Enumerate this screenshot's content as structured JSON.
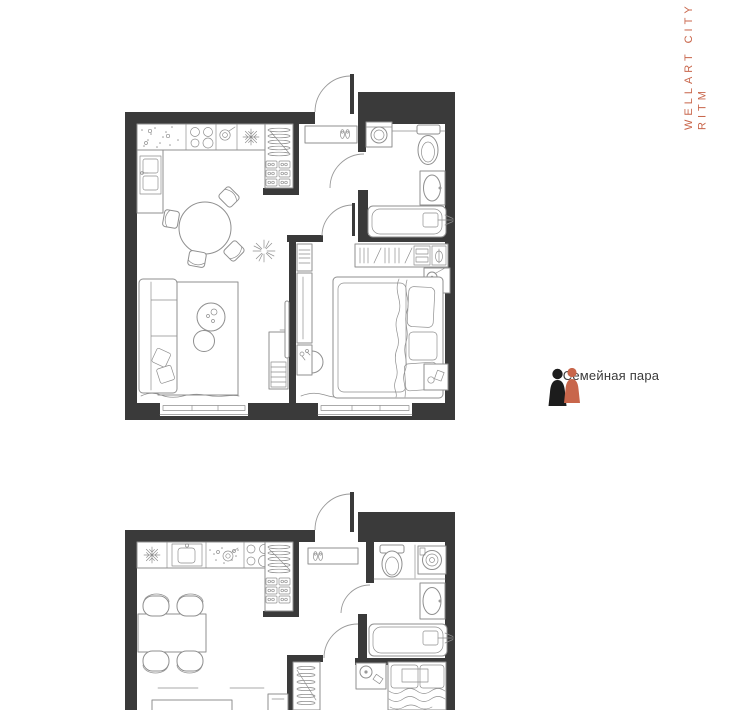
{
  "branding": {
    "line1": "WELLART CITY",
    "line2": "RITM",
    "accent_color": "#C8664B"
  },
  "legend": {
    "icon": "couple-icon",
    "label": "Семейная пара",
    "icon_colors": {
      "left_figure": "#1c1c1c",
      "right_figure": "#C8664B"
    },
    "text_color": "#3A3A3A"
  },
  "plans": [
    {
      "name": "floor-plan-top",
      "kind": "one-bedroom-apartment-plan",
      "features": [
        "entry-door",
        "hallway-shoe-bench",
        "kitchen-counter",
        "stove-icon",
        "fridge-snowflake-icon",
        "sink-icon",
        "round-dining-table",
        "four-chairs",
        "hall-closet-hangers",
        "plant-icon",
        "sofa",
        "rug",
        "coffee-tables",
        "tv-console",
        "bathroom-washing-machine",
        "toilet-icon",
        "washbasin-icon",
        "bathtub-icon",
        "wardrobe-hangers",
        "double-bed",
        "nightstand-lamp-icon",
        "two-windows-with-curtains"
      ]
    },
    {
      "name": "floor-plan-bottom",
      "kind": "one-bedroom-apartment-plan-partial",
      "features": [
        "entry-door",
        "hallway-shoe-bench",
        "fridge-snowflake-icon",
        "kitchen-sink-icon",
        "stove-icon",
        "rectangular-dining-table",
        "four-chairs",
        "hall-closet-hangers",
        "toilet-icon",
        "washing-machine-icon",
        "washbasin-icon",
        "bathtub-icon",
        "wardrobe-hangers",
        "double-bed-partial",
        "nightstand-lamp-icon",
        "desk-partial",
        "tv-unit-partial"
      ]
    }
  ],
  "colors": {
    "wall": "#3A3A3A",
    "furniture_line": "#8F8F8F",
    "background": "#FFFFFF"
  }
}
